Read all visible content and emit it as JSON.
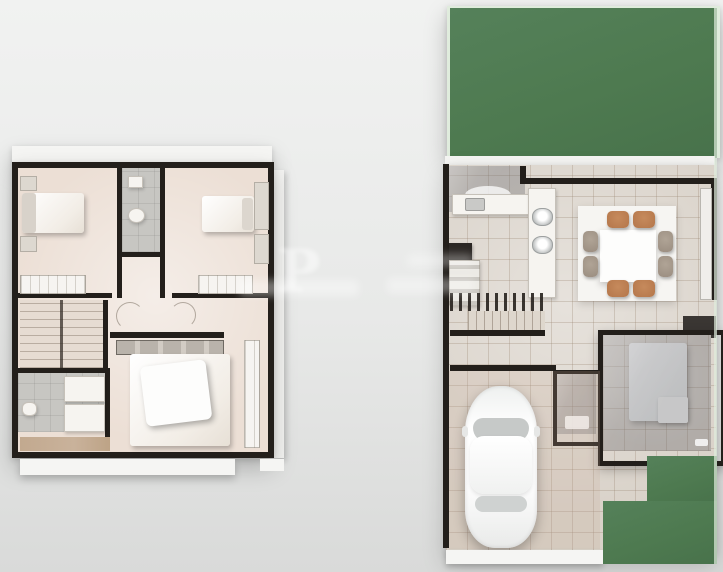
{
  "scene": {
    "type": "3d-floor-plan-render",
    "watermark_glyph": "P"
  },
  "colors": {
    "background_top": "#f1f2f1",
    "background_bottom": "#d9dad9",
    "wall": "#231f1b",
    "bedroom_floor": "#ecdfd5",
    "bath_floor": "#c7c6c2",
    "tile_floor": "#d9d2c9",
    "lawn_green": "#4e7a50",
    "lawn_edge": "#e0ecdd",
    "wood_balcony": "#c9b29b",
    "chair_brown": "#b4764a",
    "chair_gray": "#9a8d80",
    "car_white": "#fbfbfb",
    "white_trim": "#f5f5f3"
  },
  "left_plan": {
    "label": "upper-floor-plan",
    "features": [
      "bedroom-top-left",
      "bathroom-middle",
      "bedroom-top-right",
      "hallway",
      "staircase",
      "bathroom-bottom-left",
      "master-bedroom",
      "wood-balcony-strip",
      "closets",
      "roof-trim"
    ]
  },
  "right_plan": {
    "label": "ground-floor-plan",
    "features": [
      "backyard-lawn",
      "service-patio",
      "kitchen-counter",
      "kitchen-appliance",
      "island-double-sink",
      "dining-rug",
      "dining-table",
      "eight-chairs",
      "staircase",
      "entry-bathroom",
      "glass-roof-bedroom",
      "bed",
      "side-table",
      "driveway",
      "car",
      "front-lawn",
      "curb"
    ]
  }
}
